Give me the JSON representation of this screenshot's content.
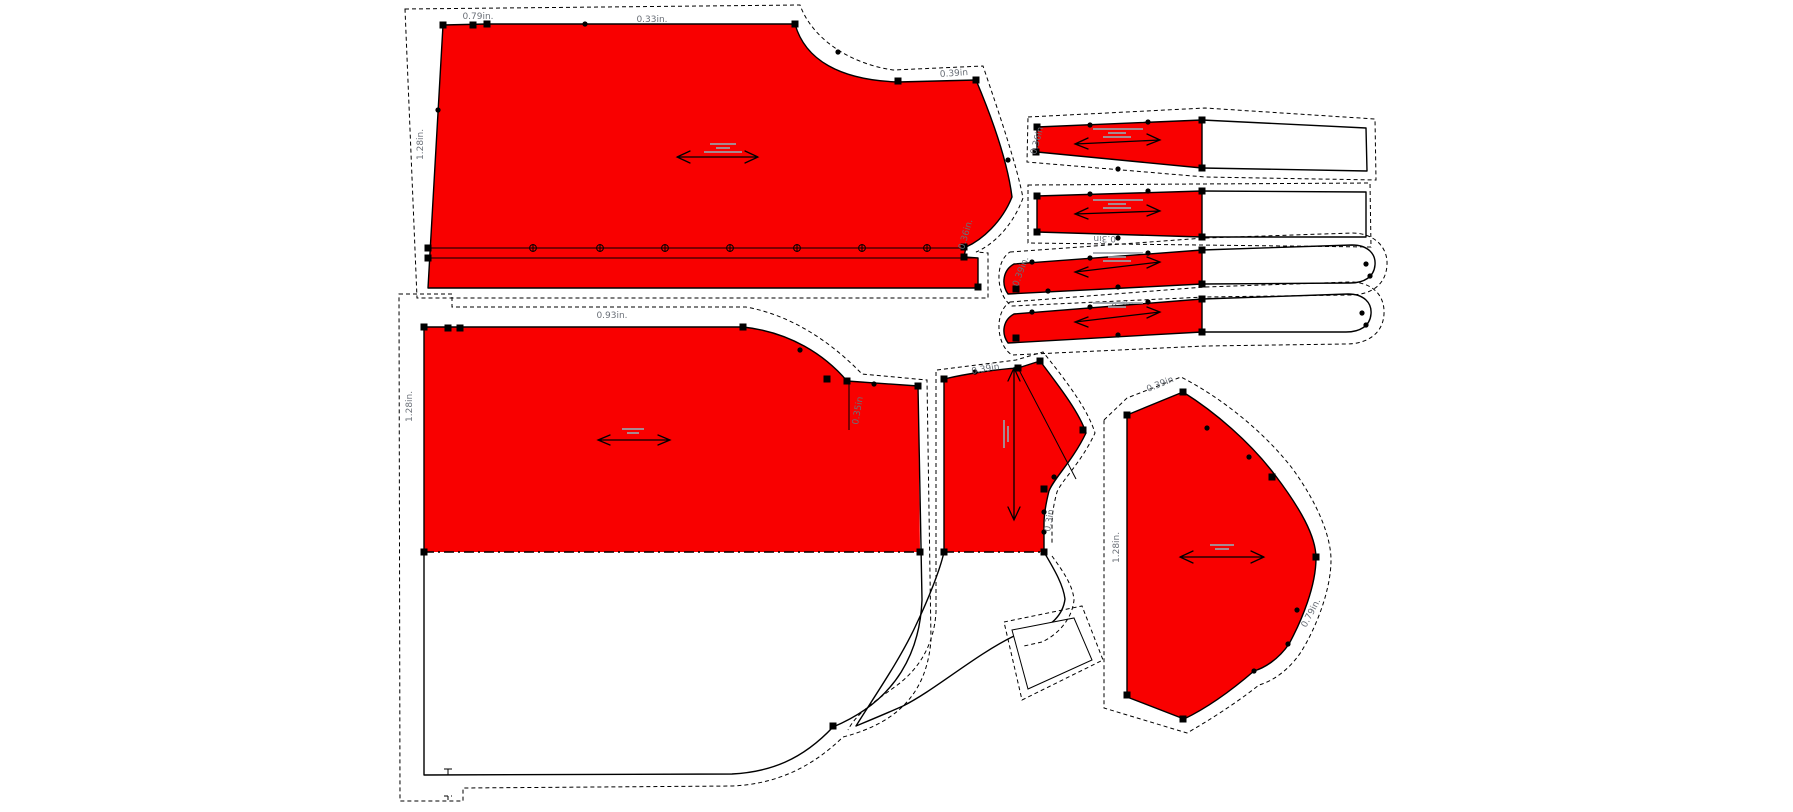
{
  "canvas": {
    "width": 1793,
    "height": 812,
    "background": "#ffffff"
  },
  "colors": {
    "piece_fill": "#f90000",
    "line": "#000000",
    "label": "#6b7078"
  },
  "pieces": {
    "back_bodice_top": {
      "labels": {
        "top_left_width": "0.79in.",
        "top_width": "0.33in.",
        "left_height": "1.28in.",
        "shoulder": "0.39in",
        "armhole": "0.36in."
      }
    },
    "front_bodice_bottom": {
      "labels": {
        "top_width": "0.93in.",
        "left_height": "1.28in.",
        "slit": "0.35in"
      }
    },
    "side_panel": {
      "labels": {
        "top_edge": "0.39in",
        "curve": "0.3in"
      }
    },
    "sleeve": {
      "labels": {
        "top_edge": "0.39in",
        "left_height": "1.28in.",
        "curve": "0.79in."
      }
    },
    "strip_1": {
      "labels": {
        "left_edge": "0.36in"
      }
    },
    "strip_2": {
      "labels": {
        "bottom_edge": "0.3in"
      }
    },
    "strip_3": {
      "labels": {
        "left_edge": "0.39in.",
        "bottom_edge": "0.3in"
      }
    }
  }
}
